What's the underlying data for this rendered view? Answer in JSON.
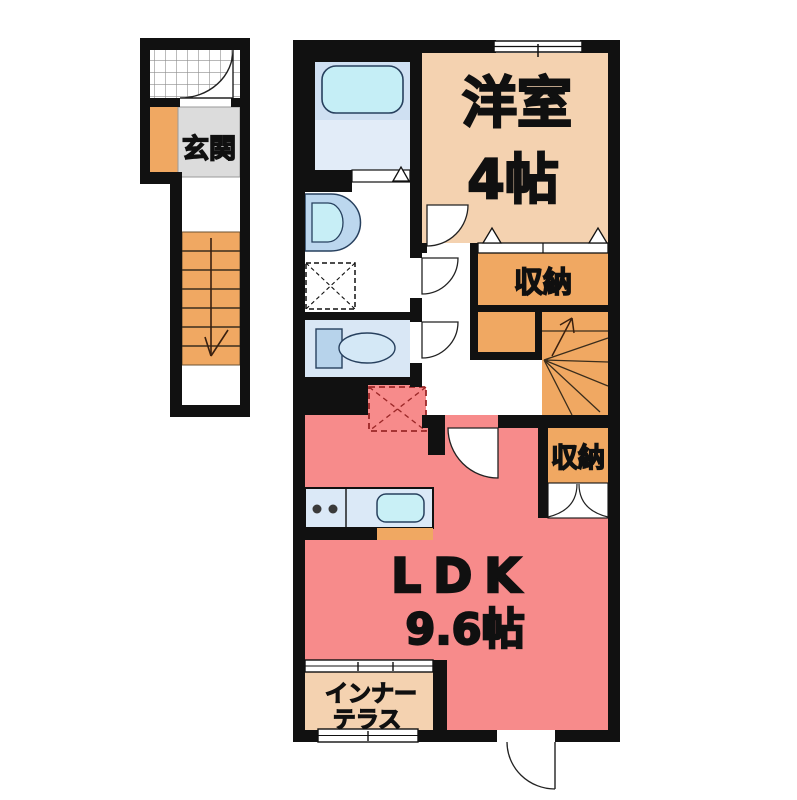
{
  "plan": {
    "rooms": {
      "genkan": {
        "label": "玄関"
      },
      "western_room": {
        "label": "洋室",
        "size": "4帖"
      },
      "storage_upper": {
        "label": "収納"
      },
      "storage_lower": {
        "label": "収納"
      },
      "ldk": {
        "label": "LDK",
        "size": "9.6帖"
      },
      "inner_terrace": {
        "label_line1": "インナー",
        "label_line2": "テラス"
      }
    },
    "icons": [
      "bathtub-icon",
      "folding-door-icon",
      "washbasin-icon",
      "washing-machine-space-icon",
      "toilet-icon",
      "refrigerator-space-icon",
      "kitchen-stove-icon",
      "kitchen-sink-icon",
      "door-swing-icon",
      "sliding-door-icon",
      "double-door-icon",
      "window-icon",
      "stairs-down-arrow-icon",
      "stairs-up-arrow-icon",
      "porch-tile-icon"
    ],
    "colors": {
      "wall": "#111111",
      "room_tan": "#f4d2b0",
      "ldk_pink": "#f78b8b",
      "storage_orange": "#f0a862",
      "genkan_gray": "#dcdcdc",
      "bath_floor_blue": "#e2ecf8",
      "tub_panel_blue": "#cfe0f2",
      "tub_cyan": "#c5eef6",
      "fixture_blue": "#bcd7ee",
      "toilet_room_blue": "#d9e7f5",
      "kitchen_counter_blue": "#dbe9f7",
      "dashed_red": "#9b2727"
    }
  }
}
